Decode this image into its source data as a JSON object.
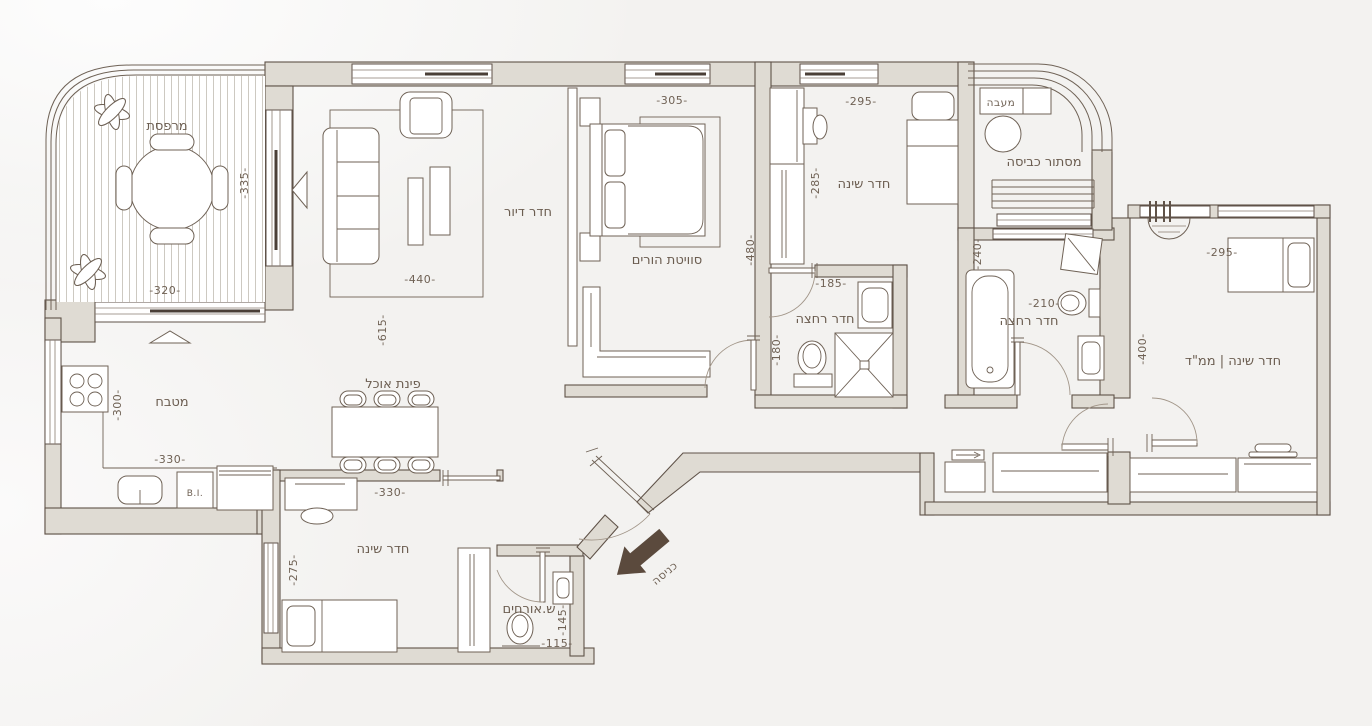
{
  "colors": {
    "wall_fill": "#dfdbd3",
    "line": "#5f5248",
    "text": "#6b5d50",
    "arrow": "#5b4a3d",
    "background": "#f3f2f0"
  },
  "labels": {
    "terrace": "מרפסת",
    "living": "חדר דיור",
    "master": "סוויטת הורים",
    "bedroom_top": "חדר שינה",
    "laundry": "מסתור כביסה",
    "condenser": "מעבה",
    "bath_mid": "חדר רחצה",
    "bath_right": "חדר רחצה",
    "mamad": "חדר שינה | ממ\"ד",
    "kitchen": "מטבח",
    "dining": "פינת אוכל",
    "bedroom_bottom": "חדר שינה",
    "guest_wc": "ש.אורחים",
    "entrance": "כניסה",
    "built_in": "B.I."
  },
  "dimensions": {
    "terrace_v": "-335-",
    "terrace_h": "-320-",
    "living_h": "-440-",
    "living_v": "-615-",
    "master_h": "-305-",
    "master_v": "-480-",
    "bedroom_top_h": "-295-",
    "bedroom_top_v": "-285-",
    "bath_mid_h": "-185-",
    "bath_mid_v": "-180-",
    "bath_right_h": "-210-",
    "bath_right_v": "-240-",
    "mamad_h": "-295-",
    "mamad_v": "-400-",
    "kitchen_v": "-300-",
    "kitchen_h": "-330-",
    "bedroom_bottom_h": "-330-",
    "bedroom_bottom_v": "-275-",
    "guest_wc_v": "-145-",
    "guest_wc_h": "-115-"
  }
}
